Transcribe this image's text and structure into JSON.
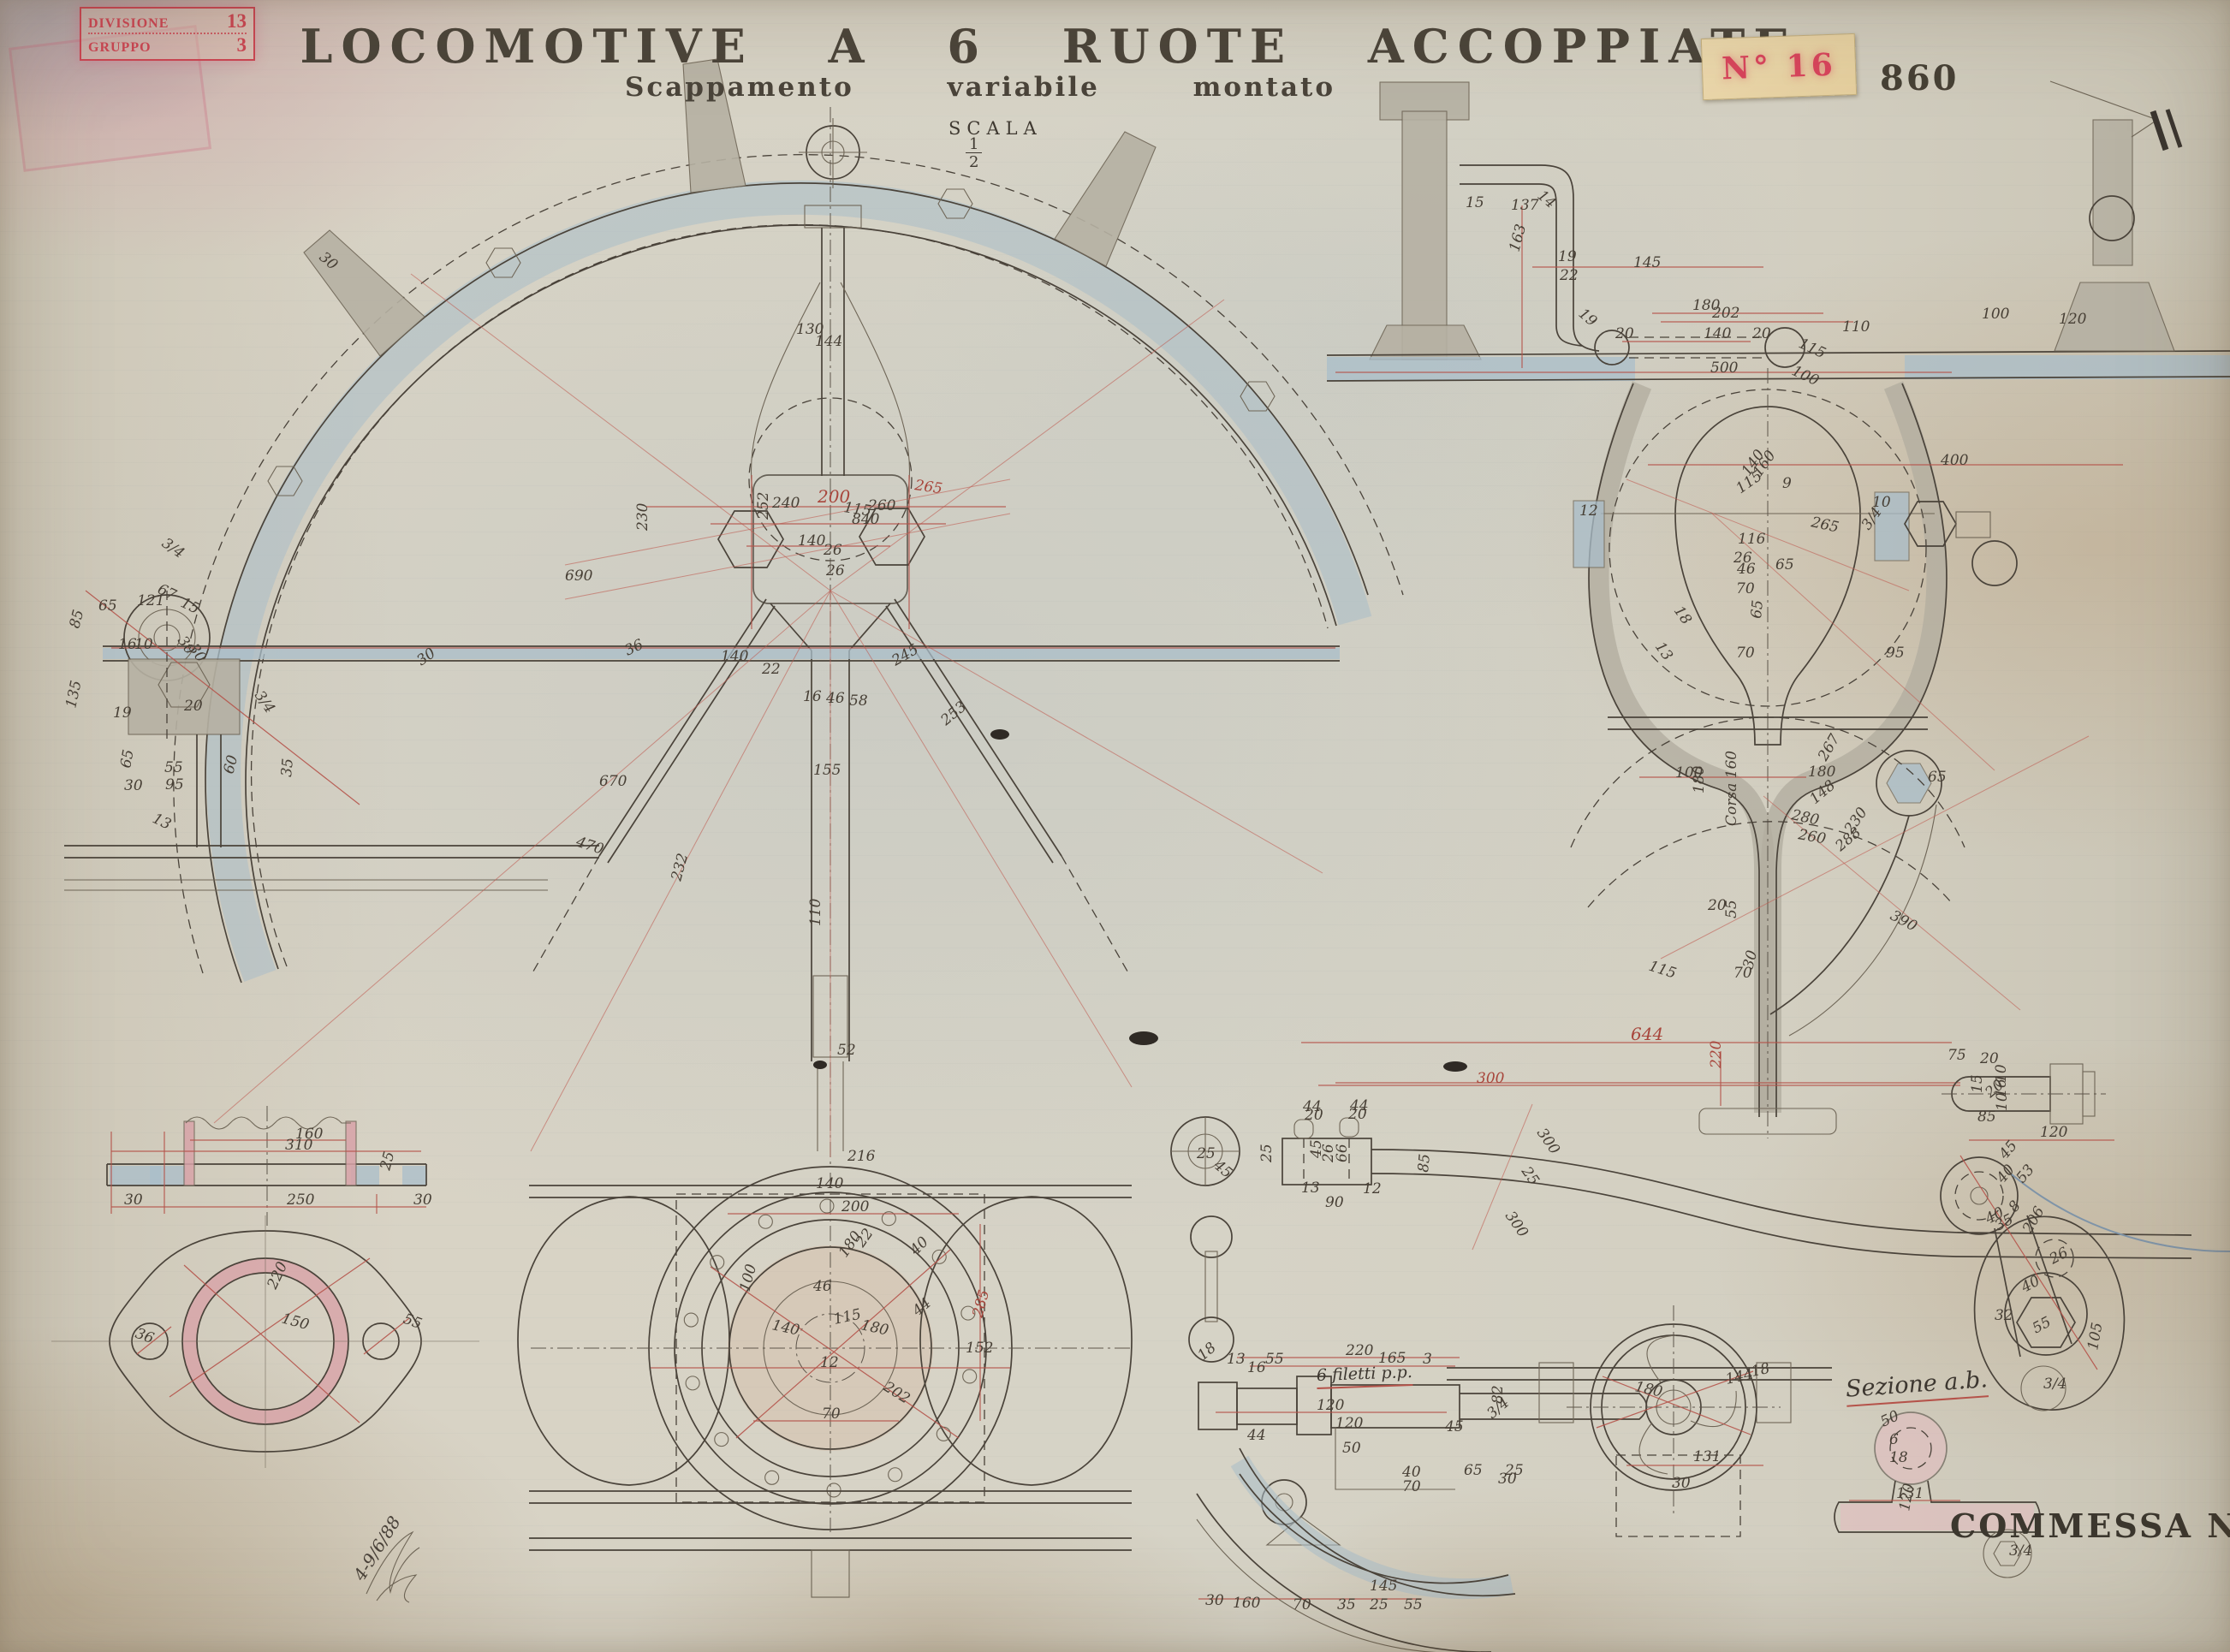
{
  "header": {
    "title": "LOCOMOTIVE A 6 RUOTE ACCOPPIATE",
    "subtitle": "Scappamento variabile montato",
    "scale_label": "SCALA",
    "scale_num": "1",
    "scale_den": "2"
  },
  "stamps": {
    "division_label": "DIVISIONE",
    "division_value": "13",
    "group_label": "GRUPPO",
    "group_value": "3",
    "tag_number": "N° 16",
    "plate_number": "860",
    "commessa": "COMMESSA N° 6994"
  },
  "notes": {
    "section_note": "Sezione a.b.",
    "thread_note": "6 filetti p.p.",
    "date_signature": "4-9/6/88"
  },
  "colors": {
    "paper": "#d6d2c4",
    "ink": "#4a433a",
    "dimension_red": "#b5534a",
    "stamp_red": "#cc4653",
    "section_pink": "#d8a3a8",
    "metal_blue": "#a9bdc9",
    "sticker_cream": "#ead7ac"
  },
  "dim_labels": [
    [
      "200",
      955,
      587,
      0,
      "r",
      20
    ],
    [
      "115",
      985,
      598,
      8
    ],
    [
      "265",
      1068,
      572,
      8,
      "r"
    ],
    [
      "840",
      995,
      612
    ],
    [
      "140",
      932,
      637
    ],
    [
      "26",
      962,
      648
    ],
    [
      "26",
      965,
      672
    ],
    [
      "690",
      660,
      678
    ],
    [
      "670",
      700,
      918
    ],
    [
      "470",
      672,
      988,
      18
    ],
    [
      "230",
      756,
      620,
      -90
    ],
    [
      "130",
      930,
      390
    ],
    [
      "144",
      952,
      404
    ],
    [
      "16",
      938,
      819
    ],
    [
      "46",
      965,
      821
    ],
    [
      "58",
      992,
      824
    ],
    [
      "240",
      902,
      593
    ],
    [
      "260",
      1014,
      596
    ],
    [
      "36",
      733,
      766,
      -25
    ],
    [
      "140",
      842,
      772
    ],
    [
      "22",
      890,
      787
    ],
    [
      "245",
      1046,
      778,
      -30
    ],
    [
      "252",
      897,
      607,
      -90
    ],
    [
      "30",
      492,
      778,
      -35
    ],
    [
      "253",
      1105,
      848,
      -40
    ],
    [
      "155",
      950,
      905
    ],
    [
      "110",
      958,
      1082,
      -90
    ],
    [
      "52",
      978,
      1232
    ],
    [
      "232",
      795,
      1030,
      -75
    ],
    [
      "30",
      372,
      302,
      40
    ],
    [
      "65",
      115,
      713
    ],
    [
      "121",
      160,
      707
    ],
    [
      "85",
      92,
      735,
      -75
    ],
    [
      "16",
      138,
      758
    ],
    [
      "10",
      157,
      758
    ],
    [
      "135",
      88,
      828,
      -78
    ],
    [
      "67",
      183,
      692,
      25
    ],
    [
      "15",
      210,
      708,
      25
    ],
    [
      "30",
      207,
      748,
      55
    ],
    [
      "30",
      220,
      757,
      55
    ],
    [
      "20",
      215,
      830
    ],
    [
      "65",
      152,
      898,
      -80
    ],
    [
      "55",
      192,
      902
    ],
    [
      "60",
      272,
      905,
      -75
    ],
    [
      "95",
      193,
      922
    ],
    [
      "35",
      340,
      908,
      -85
    ],
    [
      "30",
      145,
      923
    ],
    [
      "19",
      132,
      838
    ],
    [
      "3/4",
      188,
      637,
      35
    ],
    [
      "3/4",
      297,
      812,
      55
    ],
    [
      "13",
      177,
      960,
      25
    ],
    [
      "137",
      1765,
      245
    ],
    [
      "163",
      1774,
      295,
      -75
    ],
    [
      "19",
      1820,
      305
    ],
    [
      "22",
      1822,
      327
    ],
    [
      "145",
      1908,
      312
    ],
    [
      "19",
      1843,
      368,
      40
    ],
    [
      "180",
      1977,
      362
    ],
    [
      "202",
      2000,
      371
    ],
    [
      "140",
      1990,
      395
    ],
    [
      "20",
      1887,
      395
    ],
    [
      "20",
      2047,
      395
    ],
    [
      "115",
      2100,
      405,
      25
    ],
    [
      "500",
      1998,
      435
    ],
    [
      "100",
      2092,
      437,
      25
    ],
    [
      "14",
      1795,
      230,
      40
    ],
    [
      "110",
      2152,
      387
    ],
    [
      "120",
      2405,
      378
    ],
    [
      "100",
      2315,
      372
    ],
    [
      "15",
      1712,
      242
    ],
    [
      "400",
      2267,
      543
    ],
    [
      "115",
      2033,
      577,
      -35
    ],
    [
      "140",
      2043,
      557,
      -55
    ],
    [
      "160",
      2056,
      558,
      -55
    ],
    [
      "9",
      2082,
      570
    ],
    [
      "265",
      2115,
      615,
      12
    ],
    [
      "65",
      2074,
      665
    ],
    [
      "116",
      2030,
      635
    ],
    [
      "26",
      2025,
      657
    ],
    [
      "46",
      2029,
      670
    ],
    [
      "70",
      2028,
      693
    ],
    [
      "70",
      2028,
      768
    ],
    [
      "65",
      2057,
      723,
      -85
    ],
    [
      "18",
      1955,
      713,
      55
    ],
    [
      "13",
      1933,
      755,
      55
    ],
    [
      "95",
      2203,
      768
    ],
    [
      "10",
      2187,
      592
    ],
    [
      "12",
      1845,
      602
    ],
    [
      "3/4",
      2183,
      620,
      -55
    ],
    [
      "100",
      1957,
      908
    ],
    [
      "180",
      2112,
      907
    ],
    [
      "267",
      2133,
      890,
      -60
    ],
    [
      "280",
      2092,
      957,
      12
    ],
    [
      "260",
      2100,
      980,
      10
    ],
    [
      "230",
      2163,
      975,
      -55
    ],
    [
      "390",
      2207,
      1073,
      28
    ],
    [
      "Corsa 160",
      2028,
      965,
      -90
    ],
    [
      "180",
      1990,
      927,
      -90
    ],
    [
      "55",
      2028,
      1073,
      -90
    ],
    [
      "20",
      1995,
      1063
    ],
    [
      "65",
      2252,
      913
    ],
    [
      "30",
      2047,
      1133,
      -75
    ],
    [
      "70",
      2025,
      1142
    ],
    [
      "115",
      1925,
      1133,
      18
    ],
    [
      "288",
      2150,
      995,
      -40
    ],
    [
      "148",
      2120,
      940,
      -40
    ],
    [
      "644",
      1905,
      1215,
      0,
      "r",
      20
    ],
    [
      "300",
      1725,
      1265,
      0,
      "r"
    ],
    [
      "220",
      2010,
      1248,
      -90,
      "r"
    ],
    [
      "160",
      345,
      1330
    ],
    [
      "310",
      333,
      1343
    ],
    [
      "250",
      335,
      1407
    ],
    [
      "30",
      145,
      1407
    ],
    [
      "30",
      483,
      1407
    ],
    [
      "25",
      455,
      1368,
      -75
    ],
    [
      "220",
      322,
      1507,
      -65
    ],
    [
      "150",
      328,
      1545,
      15
    ],
    [
      "36",
      157,
      1562,
      20
    ],
    [
      "55",
      470,
      1545,
      20
    ],
    [
      "200",
      983,
      1415
    ],
    [
      "22",
      1008,
      1458,
      -55
    ],
    [
      "180",
      988,
      1470,
      -55
    ],
    [
      "46",
      950,
      1508
    ],
    [
      "100",
      875,
      1510,
      -75
    ],
    [
      "140",
      901,
      1553,
      12
    ],
    [
      "115",
      975,
      1547,
      -12
    ],
    [
      "180",
      1005,
      1553,
      12
    ],
    [
      "44",
      1072,
      1538,
      -40
    ],
    [
      "202",
      1031,
      1623,
      32
    ],
    [
      "12",
      958,
      1597
    ],
    [
      "70",
      960,
      1657
    ],
    [
      "285",
      1147,
      1540,
      -75,
      "r"
    ],
    [
      "140",
      953,
      1388
    ],
    [
      "40",
      1070,
      1467,
      -45
    ],
    [
      "216",
      990,
      1356
    ],
    [
      "152",
      1128,
      1580
    ],
    [
      "220",
      1572,
      1583
    ],
    [
      "165",
      1610,
      1592
    ],
    [
      "55",
      1478,
      1593
    ],
    [
      "13",
      1433,
      1593
    ],
    [
      "16",
      1457,
      1603
    ],
    [
      "120",
      1538,
      1647
    ],
    [
      "120",
      1560,
      1668
    ],
    [
      "44",
      1457,
      1682
    ],
    [
      "50",
      1568,
      1697
    ],
    [
      "45",
      1688,
      1672
    ],
    [
      "40",
      1638,
      1725
    ],
    [
      "70",
      1638,
      1742
    ],
    [
      "65",
      1710,
      1723
    ],
    [
      "25",
      1758,
      1723
    ],
    [
      "30",
      1750,
      1733
    ],
    [
      "3",
      1662,
      1593
    ],
    [
      "3/4",
      1743,
      1658,
      -40
    ],
    [
      "18",
      1405,
      1590,
      -40
    ],
    [
      "44",
      1522,
      1298
    ],
    [
      "44",
      1577,
      1297
    ],
    [
      "20",
      1524,
      1308
    ],
    [
      "20",
      1575,
      1307
    ],
    [
      "45",
      1543,
      1353,
      -90
    ],
    [
      "26",
      1557,
      1358,
      -90
    ],
    [
      "66",
      1573,
      1358,
      -90
    ],
    [
      "25",
      1485,
      1358,
      -90
    ],
    [
      "90",
      1548,
      1410
    ],
    [
      "13",
      1520,
      1393
    ],
    [
      "12",
      1592,
      1394
    ],
    [
      "85",
      1668,
      1370,
      -85
    ],
    [
      "300",
      1795,
      1323,
      55
    ],
    [
      "25",
      1777,
      1368,
      55
    ],
    [
      "300",
      1758,
      1420,
      55
    ],
    [
      "25",
      1398,
      1353
    ],
    [
      "45",
      1417,
      1363,
      40
    ],
    [
      "180",
      1909,
      1625,
      12
    ],
    [
      "144",
      2017,
      1617,
      -12
    ],
    [
      "18",
      2047,
      1608,
      -12
    ],
    [
      "131",
      1978,
      1707
    ],
    [
      "30",
      1953,
      1738
    ],
    [
      "75",
      2275,
      1238
    ],
    [
      "20",
      2313,
      1242
    ],
    [
      "15",
      2315,
      1277,
      -90
    ],
    [
      "10",
      2343,
      1265,
      -90
    ],
    [
      "16",
      2343,
      1282,
      -90
    ],
    [
      "20",
      2325,
      1283,
      -40
    ],
    [
      "10",
      2344,
      1298,
      -90
    ],
    [
      "85",
      2310,
      1310
    ],
    [
      "120",
      2383,
      1328
    ],
    [
      "45",
      2343,
      1355,
      -50
    ],
    [
      "40",
      2340,
      1383,
      -50
    ],
    [
      "53",
      2363,
      1383,
      -50
    ],
    [
      "8",
      2354,
      1417,
      -50
    ],
    [
      "40",
      2323,
      1430,
      -28
    ],
    [
      "35",
      2334,
      1438,
      -28
    ],
    [
      "206",
      2372,
      1442,
      -60
    ],
    [
      "26",
      2398,
      1477,
      -28
    ],
    [
      "40",
      2365,
      1510,
      -28
    ],
    [
      "32",
      2330,
      1542
    ],
    [
      "55",
      2378,
      1558,
      -28
    ],
    [
      "105",
      2450,
      1578,
      -80
    ],
    [
      "3/4",
      2387,
      1622
    ],
    [
      "50",
      2200,
      1667,
      -25
    ],
    [
      "6",
      2207,
      1687
    ],
    [
      "18",
      2207,
      1708
    ],
    [
      "131",
      2215,
      1750
    ],
    [
      "120",
      2230,
      1766,
      -80
    ],
    [
      "3/4",
      2347,
      1817
    ],
    [
      "30",
      1408,
      1875
    ],
    [
      "160",
      1440,
      1878
    ],
    [
      "70",
      1510,
      1880
    ],
    [
      "35",
      1562,
      1880
    ],
    [
      "25",
      1600,
      1880
    ],
    [
      "55",
      1640,
      1880
    ],
    [
      "145",
      1600,
      1858
    ],
    [
      "82",
      1755,
      1640,
      -90
    ]
  ]
}
